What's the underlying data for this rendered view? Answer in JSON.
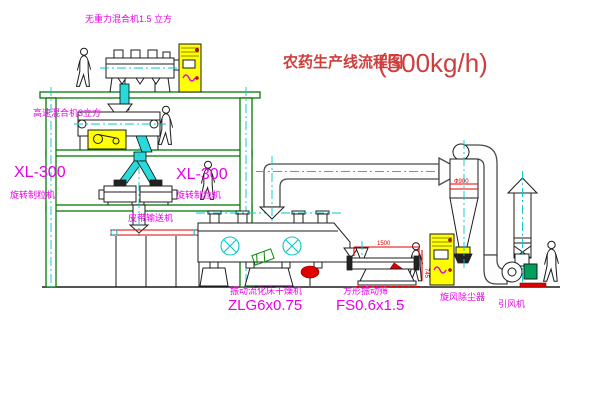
{
  "title": {
    "name": "农药生产线流程图",
    "capacity": "(500kg/h)"
  },
  "labels": {
    "mixer_top": "无重力混合机1.5 立方",
    "mixer_mid": "高速混合机3立方",
    "granulator_left": {
      "model": "XL-300",
      "name": "旋转制粒机"
    },
    "granulator_right": {
      "model": "XL-300",
      "name": "旋转制粒机"
    },
    "belt_conveyor": "皮带输送机",
    "dryer": {
      "name": "振动流化床干燥机",
      "model": "ZLG6x0.75"
    },
    "sieve": {
      "name": "方形振动筛",
      "model": "FS0.6x1.5"
    },
    "cyclone": "旋风除尘器",
    "fan": "引风机"
  },
  "dimensions": {
    "sieve_length": "1500",
    "sieve_height": "745",
    "cyclone_dia": "Ф900"
  },
  "colors": {
    "structure_green": "#067806",
    "centerline_cyan": "#00c8c8",
    "label_magenta": "#e800e8",
    "title_red": "#cf3d3d",
    "accent_red": "#e00000",
    "cabinet_yellow": "#ffff00"
  }
}
